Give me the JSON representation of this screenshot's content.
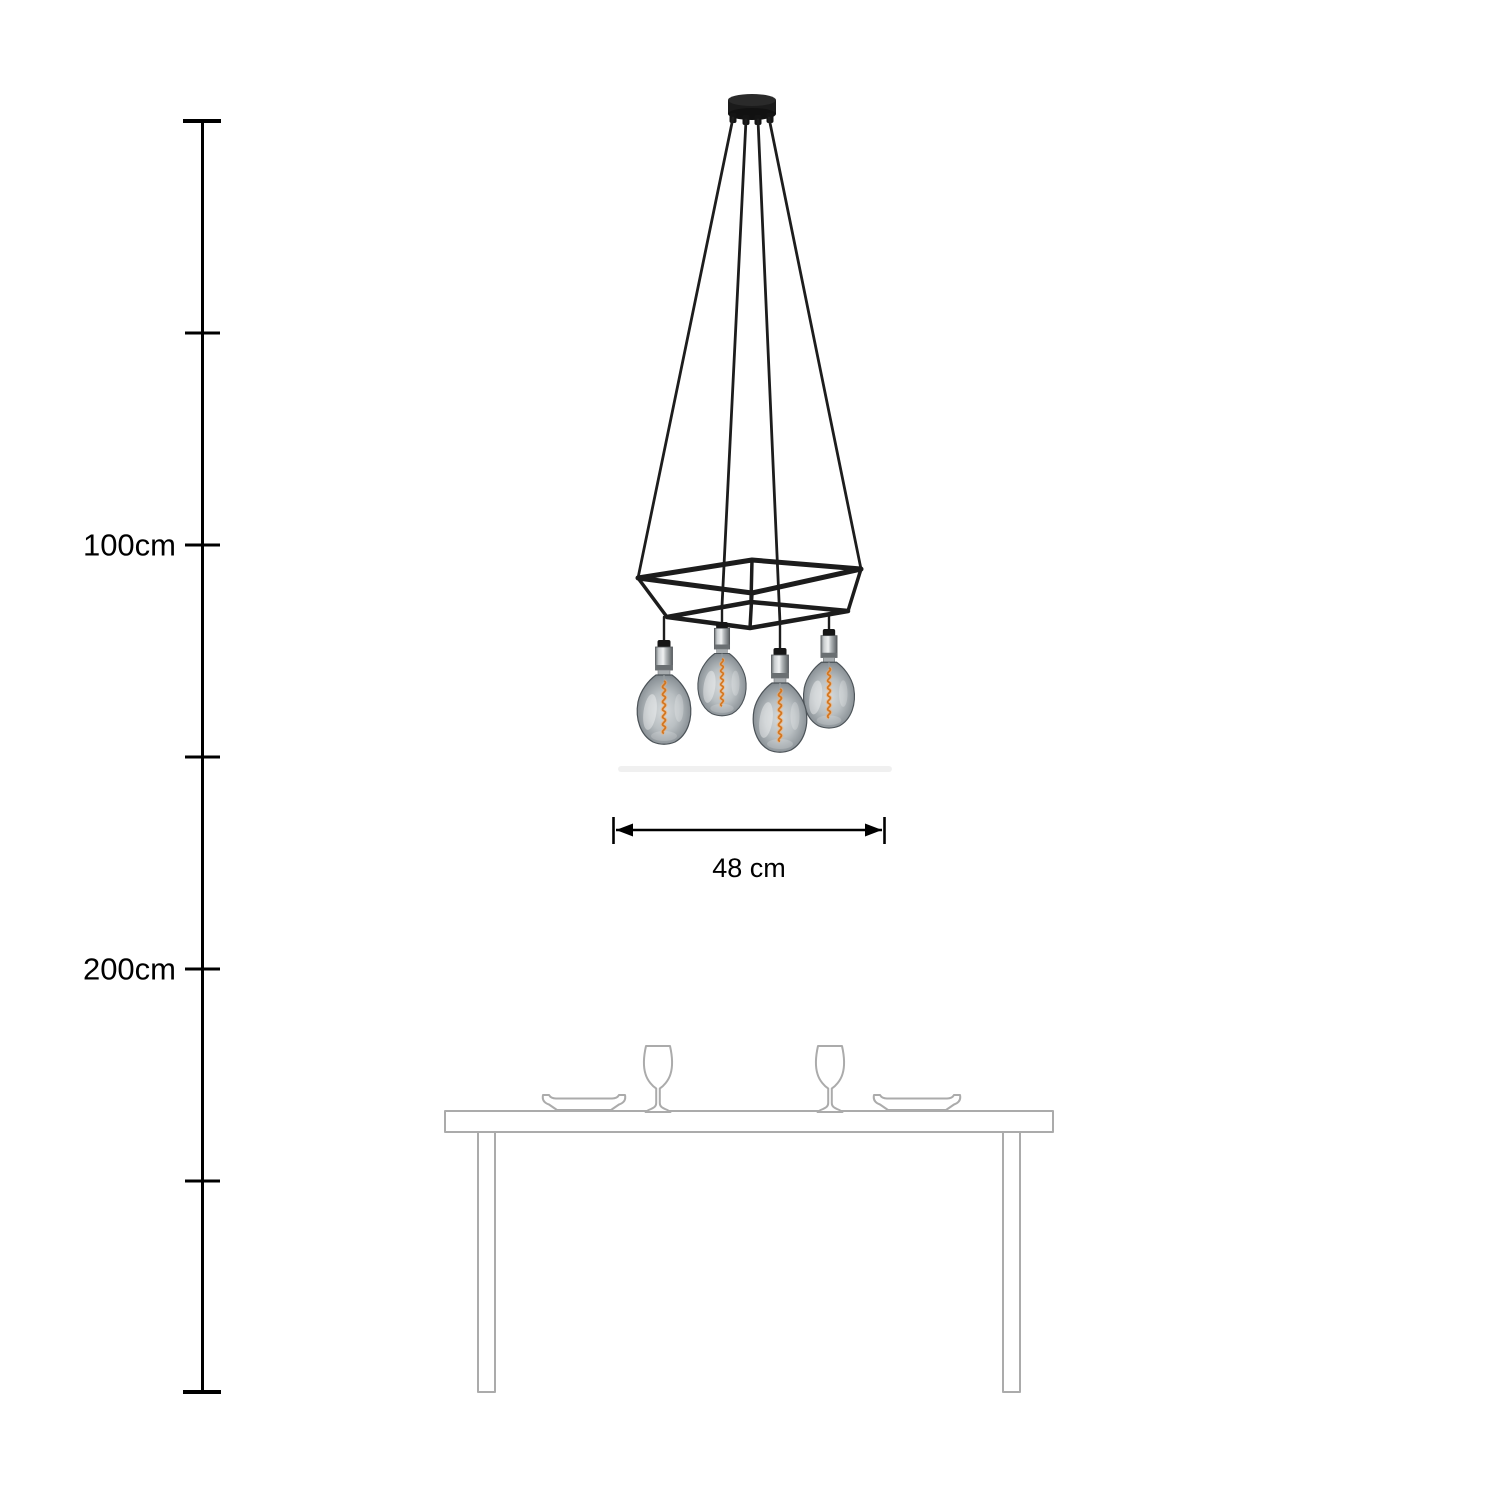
{
  "ruler": {
    "mark_100": "100cm",
    "mark_200": "200cm",
    "color": "#000000"
  },
  "dimension": {
    "width_label": "48 cm",
    "color": "#000000"
  },
  "lamp": {
    "bulb_count": 4,
    "frame_color": "#1c1c1c",
    "cable_color": "#1d1d1d",
    "rose_color": "#1b1b1b",
    "filament_color": "#d4761f",
    "filament_glow_color": "#ffad62",
    "glass_center_color": "#d6dadc",
    "glass_mid_color": "#b9bfc2",
    "glass_edge_color": "#636a70",
    "socket_chrome_light": "#eff1f2",
    "socket_chrome_dark": "#5a5e61"
  },
  "furniture": {
    "outline_color": "#ababab"
  }
}
